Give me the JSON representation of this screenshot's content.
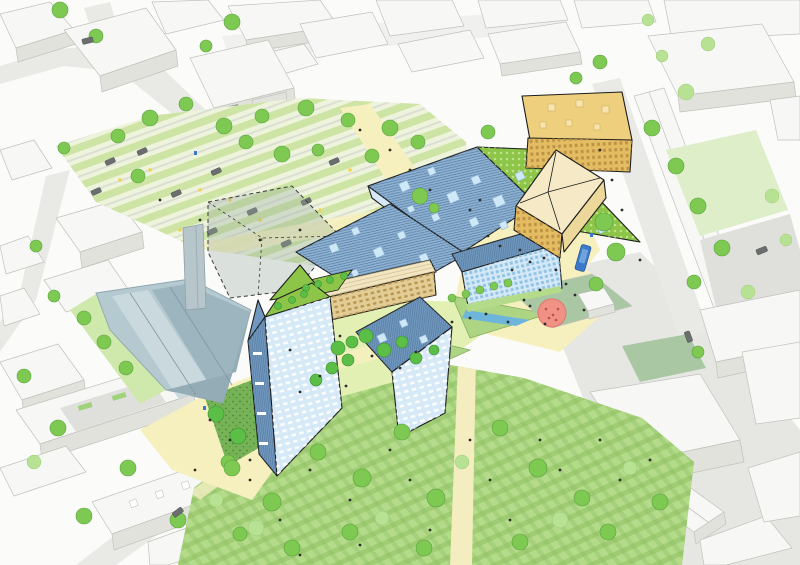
{
  "meta": {
    "type": "architectural-aerial-masterplan-illustration",
    "description": "Aerial axonometric illustration of an urban masterplan: faceted blue-roofed halls with hatched roofs, skylights and a dotted green roof, a timber-topped block and pale blue diamond-pattern facades at the centre, a golden-yellow building pair to the north-east, a retained pale-blue warehouse with chimney tower and a dashed future-phase block to the west, allotment gardens and parking rows to the north-west, a striped lawn park with a cream path to the south, a red circular playground in a sage courtyard, yellow plazas with a water rill, trees and tiny people, a blue bus on the eastern street, all surrounded by white context buildings."
  },
  "palette": {
    "background": "#fbfbf9",
    "street": "#e9eae6",
    "streetShade": "#dfe0db",
    "plazaGrey": "#e6e7e3",
    "ctxTop": "#f7f7f5",
    "ctxSide": "#e2e2dd",
    "ctxLine": "#c2c2bc",
    "treeLight": "#b7e293",
    "treeMid": "#7ec951",
    "treeDark": "#4da53c",
    "plantDark": "#5bbf47",
    "parkBase": "#b4db8a",
    "parkStripe": "#8fbf63",
    "pathCream": "#f3edc0",
    "lightYellow": "#f6f0bf",
    "allotmentBase": "#eef3dc",
    "allotmentRow": "#cde4a4",
    "gardenLight": "#e3f0b3",
    "denseGarden": "#76b356",
    "courtSage": "#a9c7a3",
    "waterBlue": "#6eb5db",
    "roofBlue": "#8fb3d4",
    "roofBlueDark": "#7199c0",
    "roofHatch": "#54779b",
    "skylight": "#cfe8f8",
    "facadeBlue": "#d6e9f6",
    "winBlue": "#90c4e6",
    "roofGreen": "#8cc548",
    "roofGreenDot": "#bfe18c",
    "timberWall": "#e3cd96",
    "timberWin": "#b8954f",
    "timberRoof": "#f1e6c3",
    "yellowRoof": "#edcf7d",
    "yellowWall": "#e4bd62",
    "yellowWin": "#bd9247",
    "creamRoof": "#f5e9c6",
    "warehouseWall": "#b4c9d0",
    "warehouseLight": "#c9d9dd",
    "warehouseShade": "#9cb5be",
    "towerGrey": "#b7c6cb",
    "playRed": "#f09186",
    "playRedDark": "#bb5148",
    "busBlue": "#3c79c9",
    "car": "#6b6e6e",
    "people": "#2d2d2d",
    "ink": "#1d1d1d"
  },
  "scene": {
    "features": [
      "context-buildings",
      "streets",
      "allotment-gardens",
      "parking-rows",
      "retained-warehouse",
      "chimney-tower",
      "future-phase-dashed-block",
      "main-hall-blue-roof",
      "green-roof",
      "market-hall-slab",
      "diamond-facade-block",
      "timber-block",
      "residential-tower-west",
      "residential-slab-south",
      "yellow-buildings",
      "central-gardens",
      "water-rill-planter",
      "pocket-courtyard",
      "playground-circle",
      "sports-court",
      "park-lawn",
      "park-path",
      "trees",
      "people",
      "bus",
      "cars"
    ]
  }
}
